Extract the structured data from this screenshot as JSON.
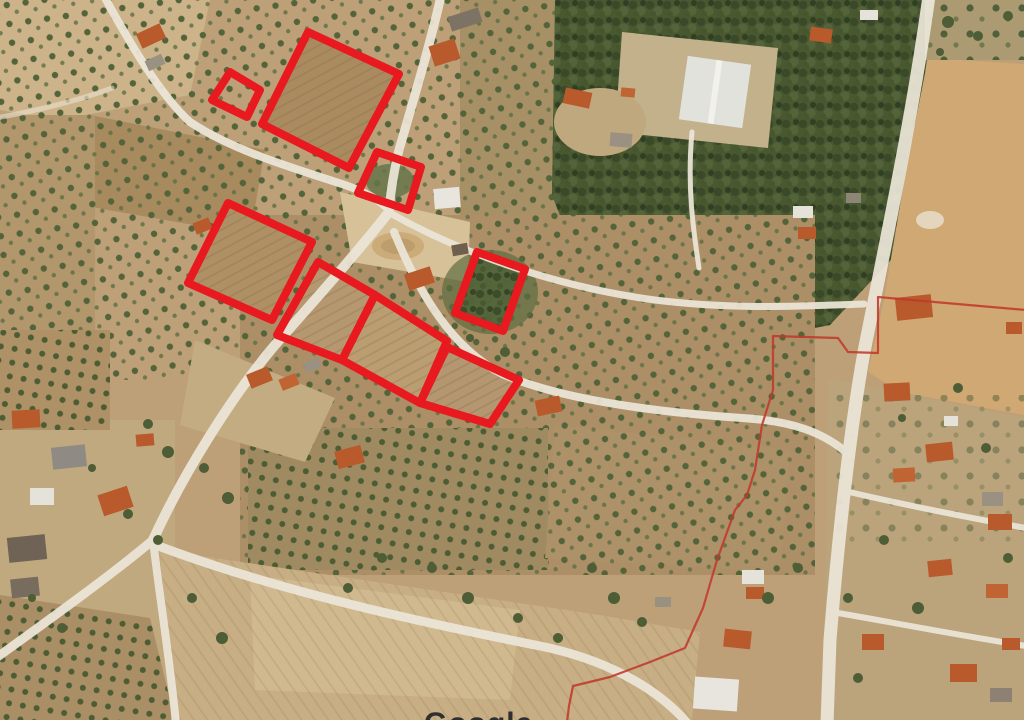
{
  "map": {
    "canvas": {
      "width": 1024,
      "height": 720
    },
    "watermark": "Google",
    "overlay": {
      "parcel_color": "#e8191f",
      "parcel_stroke_width": 8,
      "parcels": [
        {
          "id": "parcel-1",
          "points": [
            [
              230,
              72
            ],
            [
              260,
              90
            ],
            [
              247,
              117
            ],
            [
              212,
              100
            ]
          ]
        },
        {
          "id": "parcel-2",
          "points": [
            [
              308,
              32
            ],
            [
              399,
              74
            ],
            [
              349,
              168
            ],
            [
              262,
              124
            ]
          ]
        },
        {
          "id": "parcel-3",
          "points": [
            [
              377,
              152
            ],
            [
              421,
              167
            ],
            [
              408,
              210
            ],
            [
              358,
              193
            ]
          ]
        },
        {
          "id": "parcel-4",
          "points": [
            [
              228,
              203
            ],
            [
              312,
              242
            ],
            [
              272,
              320
            ],
            [
              188,
              283
            ]
          ]
        },
        {
          "id": "parcel-5",
          "points": [
            [
              318,
              262
            ],
            [
              375,
              295
            ],
            [
              342,
              360
            ],
            [
              277,
              335
            ]
          ]
        },
        {
          "id": "parcel-6",
          "points": [
            [
              375,
              295
            ],
            [
              447,
              341
            ],
            [
              420,
              403
            ],
            [
              342,
              360
            ]
          ]
        },
        {
          "id": "parcel-7",
          "points": [
            [
              447,
              347
            ],
            [
              519,
              380
            ],
            [
              490,
              424
            ],
            [
              420,
              403
            ]
          ]
        },
        {
          "id": "parcel-8",
          "points": [
            [
              477,
              252
            ],
            [
              525,
              269
            ],
            [
              503,
              331
            ],
            [
              455,
              313
            ]
          ]
        }
      ],
      "boundary_line": {
        "color": "#c0392b",
        "stroke_width": 2.2,
        "points": [
          [
            1026,
            310
          ],
          [
            878,
            297
          ],
          [
            878,
            353
          ],
          [
            848,
            352
          ],
          [
            838,
            338
          ],
          [
            773,
            336
          ],
          [
            773,
            390
          ],
          [
            762,
            425
          ],
          [
            755,
            470
          ],
          [
            747,
            495
          ],
          [
            735,
            510
          ],
          [
            717,
            560
          ],
          [
            703,
            608
          ],
          [
            685,
            648
          ],
          [
            650,
            662
          ],
          [
            610,
            677
          ],
          [
            573,
            686
          ],
          [
            569,
            706
          ],
          [
            567,
            722
          ]
        ]
      }
    }
  }
}
